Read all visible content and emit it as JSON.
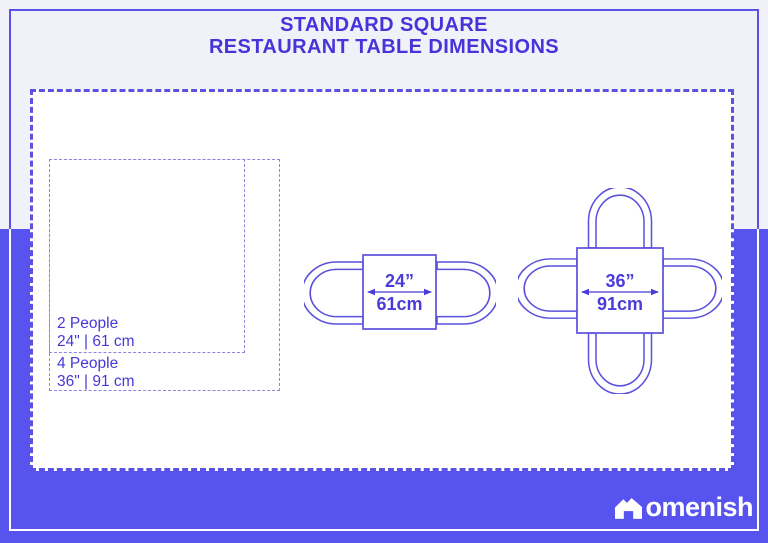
{
  "title": {
    "line1": "STANDARD SQUARE",
    "line2": "RESTAURANT TABLE DIMENSIONS"
  },
  "legend": {
    "two_people": {
      "label": "2 People",
      "dimension": "24\" | 61 cm"
    },
    "four_people": {
      "label": "4 People",
      "dimension": "36\" | 91 cm"
    }
  },
  "tables": {
    "small": {
      "seats": 2,
      "inches": "24”",
      "cm": "61cm"
    },
    "large": {
      "seats": 4,
      "inches": "36”",
      "cm": "91cm"
    }
  },
  "logo": {
    "brand": "Homenish",
    "text_part": "omenish",
    "icon": "house-icon"
  },
  "colors": {
    "accent_text": "#4634d9",
    "line_blue": "#5b50dd",
    "dash_border": "#5b52e2",
    "purple_background": "#5753ef",
    "light_background": "#f1f1fa",
    "logo_white": "#ffffff"
  }
}
